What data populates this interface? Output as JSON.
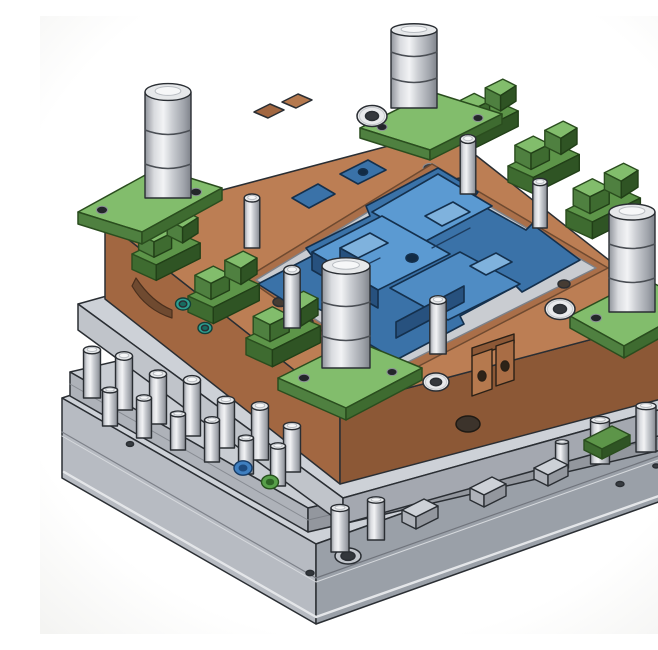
{
  "scene": {
    "description": "Isometric 3D rendering of an opened plastic injection mold tool: copper-brown cavity plate with blue core inserts and green wave interlocks on top, lifted above a gray ejector plate with steel ejector pins and a stepped gray clamp base plate, on a white background",
    "type": "3d-cad-render",
    "background": "#ffffff"
  },
  "palette": {
    "outline": "#2a2e33",
    "cavity_plate_top": "#bc7e54",
    "cavity_plate_left": "#a26741",
    "cavity_plate_right": "#8c5836",
    "pocket_floor": "#c9ccd1",
    "green_top": "#82bd6c",
    "green_mid": "#5d9549",
    "green_dark": "#3e6b30",
    "core_blue_top": "#5b9ad2",
    "core_blue_mid": "#3a72a8",
    "core_blue_dark": "#27517e",
    "plate_gray_top": "#cdd1d7",
    "plate_gray_left": "#b4b8bf",
    "plate_gray_right": "#9a9ea6",
    "steel_light": "#eceef0",
    "steel_dark": "#888c93",
    "teal_screw": "#2e9f90",
    "blue_screw": "#3f7fc0",
    "green_screw": "#58a04a",
    "latch_copper": "#b5794e"
  },
  "parts": [
    {
      "name": "cavity-plate",
      "color": "#bc7e54"
    },
    {
      "name": "core-inserts",
      "color": "#5b9ad2"
    },
    {
      "name": "wave-interlock-blocks",
      "color": "#82bd6c"
    },
    {
      "name": "corner-guide-pads",
      "color": "#82bd6c",
      "count": 4
    },
    {
      "name": "guide-pins",
      "color": "#c6c9ce",
      "count": 4
    },
    {
      "name": "support-plate",
      "color": "#cdd1d7"
    },
    {
      "name": "ejector-plate",
      "color": "#c9cdd3"
    },
    {
      "name": "ejector-pins",
      "color": "#c6c9ce"
    },
    {
      "name": "return-pins",
      "color": "#c6c9ce"
    },
    {
      "name": "base-clamp-plate",
      "color": "#cdd1d7"
    },
    {
      "name": "latch-lock",
      "color": "#b5794e"
    },
    {
      "name": "socket-cap-screws",
      "color": "#e9eaec"
    },
    {
      "name": "teal-screws",
      "color": "#2e9f90"
    },
    {
      "name": "blue-screw",
      "color": "#3f7fc0"
    },
    {
      "name": "green-screw",
      "color": "#58a04a"
    }
  ]
}
